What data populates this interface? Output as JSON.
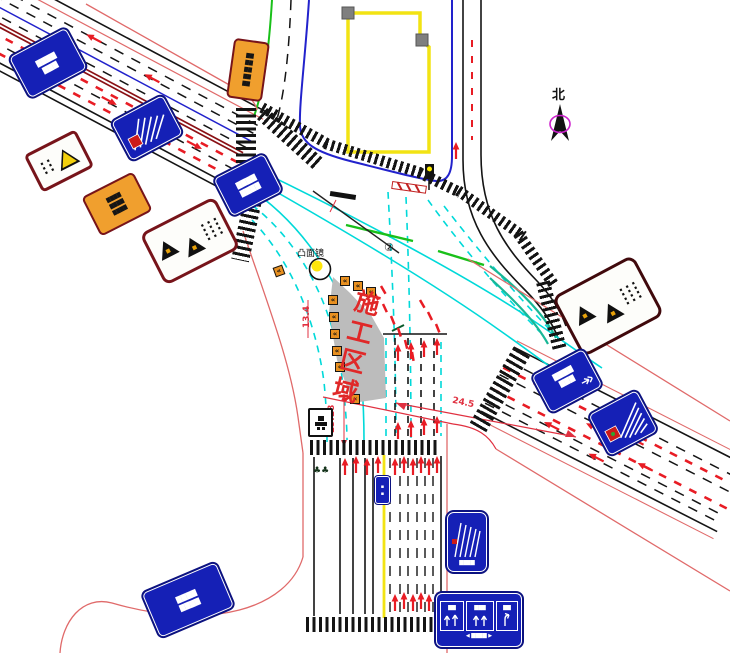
{
  "labels": {
    "north": "北",
    "construction_zone": "施工区域",
    "convex_mirror": "凸面镜",
    "note_number": "②",
    "trees": "♣♣"
  },
  "dimensions": {
    "width_a": "13.18",
    "width_b": "24.5",
    "width_c": "13.4"
  },
  "colors": {
    "sign_blue": "#1520b6",
    "warning_orange": "#f09f2e",
    "construction_gray": "#bcbcbc",
    "alert_red": "#e81c24",
    "guide_cyan": "#00d9d9",
    "curb_yellow": "#f2e313",
    "center_line_maroon": "#8a1014"
  },
  "signs": {
    "nw_road_name": {
      "rows": [
        "▇▇▇▇",
        "▇▇▇"
      ]
    },
    "west_small_warning": {
      "cols": [
        "▪▪▪",
        "▪▪▪"
      ]
    },
    "west_orange_notice": {
      "rows": [
        "▇▇▇▇",
        "▇▇▇▇",
        "▇▇▇▇"
      ]
    },
    "west_double_warning": {
      "cols": [
        "▪▪▪▪",
        "▪▪▪▪",
        "▪▪▪▪"
      ]
    },
    "north_orange_notice": {
      "rows": [
        "▇▇",
        "▇▇",
        "▇▇",
        "▇▇",
        "▇▇"
      ]
    },
    "west_crossing_blue": {
      "rows": [
        "▇▇▇▇",
        "▇▇▇▇"
      ]
    },
    "se_double_warning": {
      "cols": [
        "▪▪▪▪",
        "▪▪▪▪",
        "▪▪▪▪"
      ]
    },
    "se_direction_blue": {
      "rows": [
        "▇▇▇▇",
        "▇▇▇"
      ]
    },
    "s_lane_assign": {
      "caption": "▇▇▇▇"
    },
    "s_overhead": {
      "panel_caps": [
        "▇▇",
        "▇▇▇",
        "▇▇"
      ],
      "bottom": "◀ ▇▇▇▇ ▶"
    },
    "sw_road_name": {
      "rows": [
        "▇▇▇▇",
        "▇▇▇▇"
      ]
    },
    "median_small_blue": {
      "rows": [
        "▪",
        "▪"
      ]
    }
  }
}
